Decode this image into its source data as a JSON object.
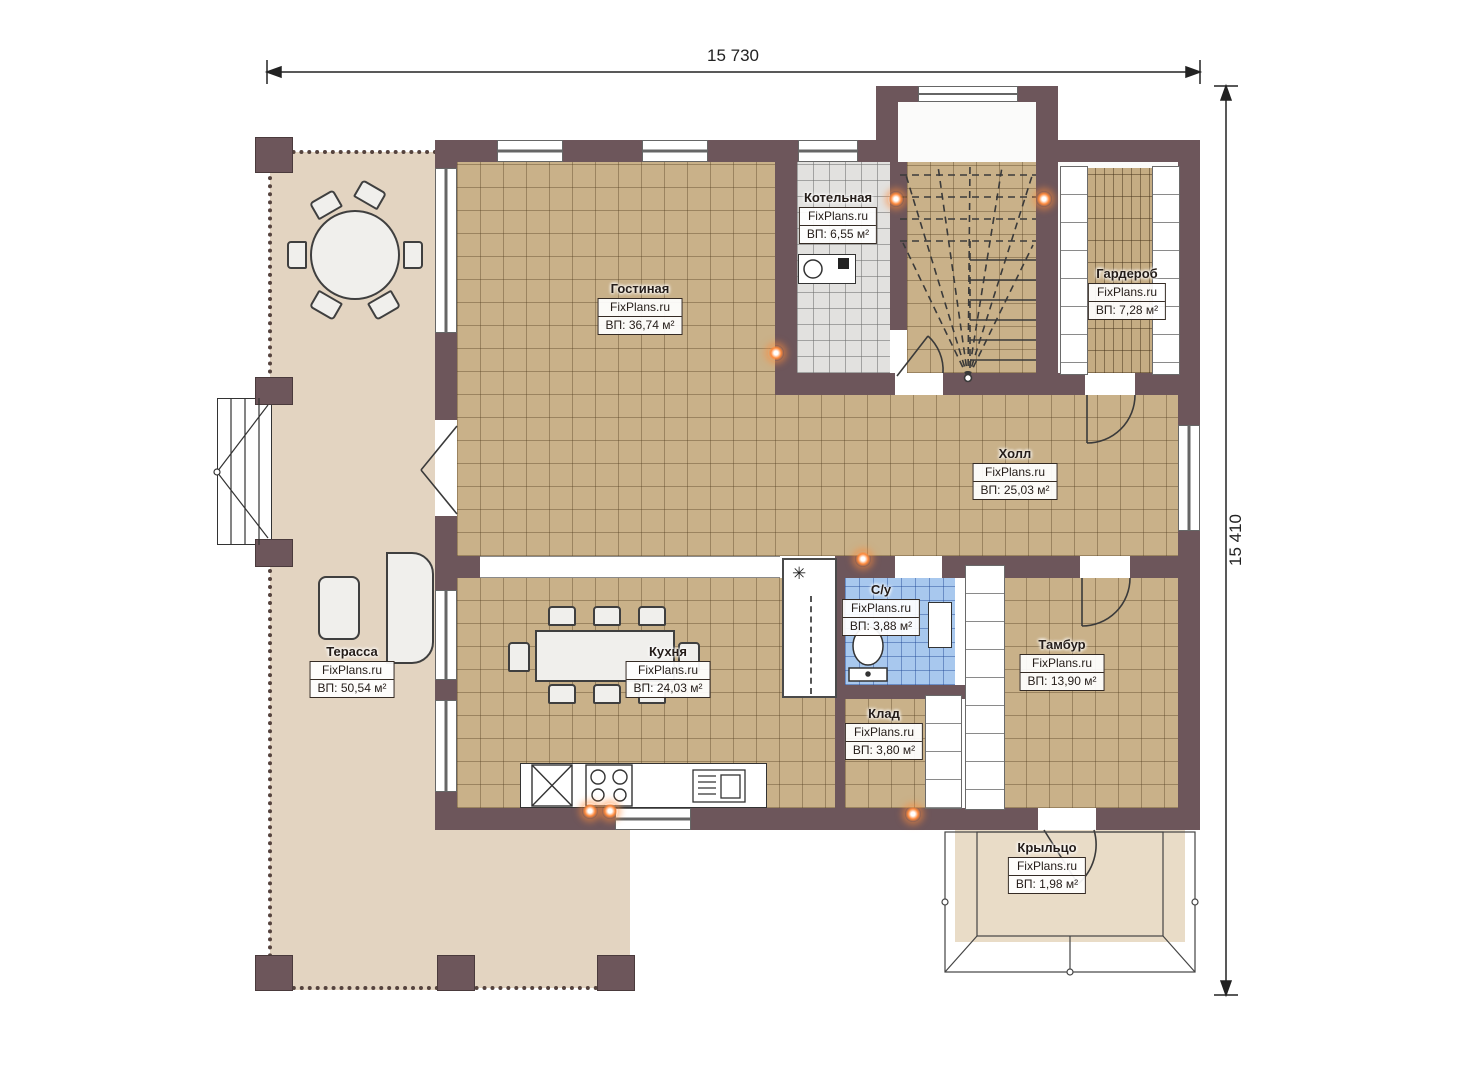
{
  "brand": "FixPlans.ru",
  "dimensions": {
    "top": "15 730",
    "right": "15 410"
  },
  "rooms": [
    {
      "id": "gostinaya",
      "name": "Гостиная",
      "area": "ВП: 36,74 м²"
    },
    {
      "id": "kotelnaya",
      "name": "Котельная",
      "area": "ВП: 6,55 м²"
    },
    {
      "id": "garderob",
      "name": "Гардероб",
      "area": "ВП: 7,28 м²"
    },
    {
      "id": "holl",
      "name": "Холл",
      "area": "ВП: 25,03 м²"
    },
    {
      "id": "terassa",
      "name": "Терасса",
      "area": "ВП: 50,54 м²"
    },
    {
      "id": "kuhnya",
      "name": "Кухня",
      "area": "ВП: 24,03 м²"
    },
    {
      "id": "su",
      "name": "С/у",
      "area": "ВП: 3,88 м²"
    },
    {
      "id": "tambur",
      "name": "Тамбур",
      "area": "ВП: 13,90 м²"
    },
    {
      "id": "klad",
      "name": "Клад",
      "area": "ВП: 3,80 м²"
    },
    {
      "id": "kryltso",
      "name": "Крыльцо",
      "area": "ВП: 1,98 м²"
    }
  ],
  "symbols": {
    "vent": "✳"
  },
  "colors": {
    "wall": "#6d565b",
    "floor_tile": "#c9b189",
    "terrace_floor": "#e3d4c1",
    "boiler_floor": "#e2e1df",
    "bath_floor": "#a8c8ee",
    "porch_floor": "#e9dcc7",
    "light_glow": "#ff8a3c"
  }
}
